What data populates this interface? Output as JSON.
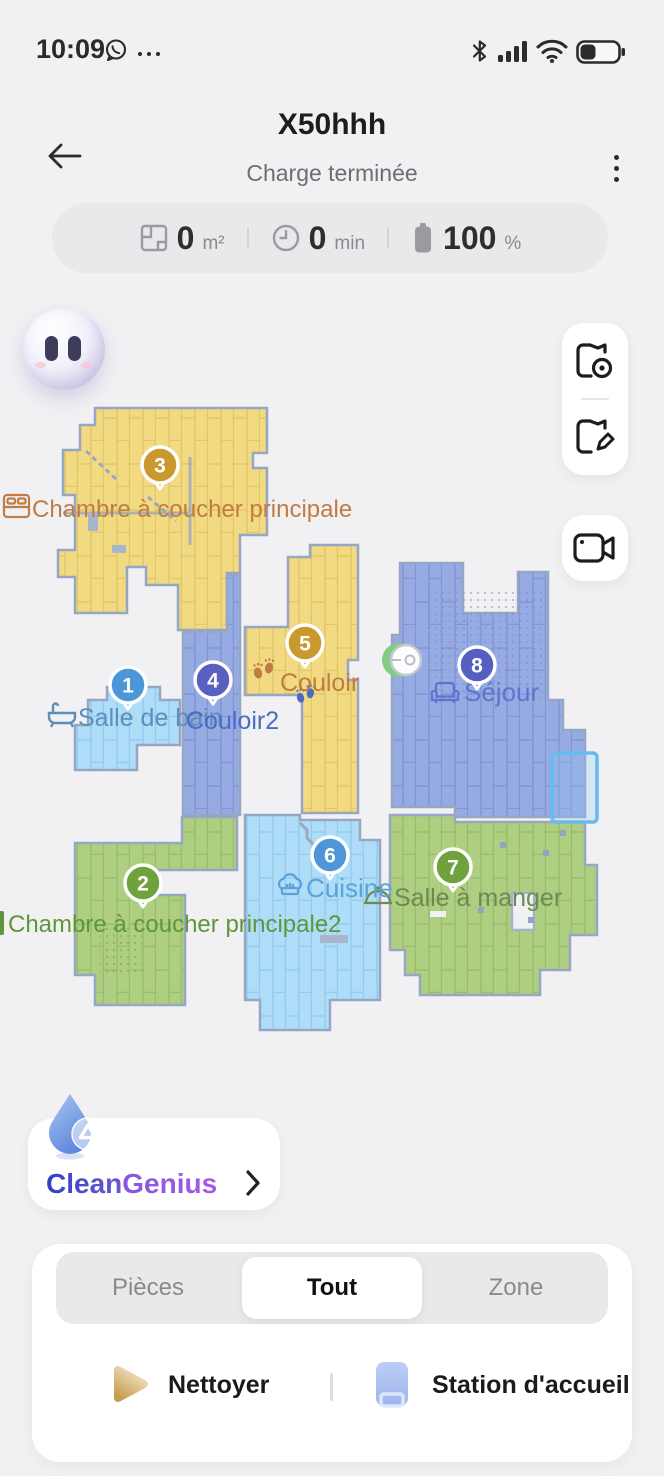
{
  "status_bar": {
    "time": "10:09",
    "whatsapp_icon": "whatsapp",
    "more_icon": "more-dots",
    "bluetooth_icon": "bluetooth",
    "signal_icon": "cellular-signal",
    "wifi_icon": "wifi",
    "battery_icon": "battery"
  },
  "header": {
    "title": "X50hhh",
    "subtitle": "Charge terminée",
    "back_icon": "back-arrow",
    "menu_icon": "kebab-menu"
  },
  "stats": {
    "area": {
      "value": "0",
      "unit": "m²"
    },
    "time": {
      "value": "0",
      "unit": "min"
    },
    "battery": {
      "value": "100",
      "unit": "%"
    }
  },
  "map": {
    "wall_color": "#96a6c4",
    "dock_icon": "robot-at-dock",
    "rooms": [
      {
        "id": 1,
        "label": "Salle de bain",
        "badge": "1",
        "badge_color": "#4d96d8",
        "label_color": "#5c8fb8",
        "fill": "#afddf8",
        "icon": "bathtub"
      },
      {
        "id": 2,
        "label": "Chambre à coucher principale2",
        "badge": "2",
        "badge_color": "#6fa23c",
        "label_color": "#5e9639",
        "fill": "#aecf82",
        "icon": "bed"
      },
      {
        "id": 3,
        "label": "Chambre à coucher principale",
        "badge": "3",
        "badge_color": "#c9982f",
        "label_color": "#c07c42",
        "fill": "#f2da82",
        "icon": "bed"
      },
      {
        "id": 4,
        "label": "Couloir2",
        "badge": "4",
        "badge_color": "#5a60c0",
        "label_color": "#4a6cc4",
        "fill": "#97abe3",
        "icon": "footprints"
      },
      {
        "id": 5,
        "label": "Couloir",
        "badge": "5",
        "badge_color": "#c9982f",
        "label_color": "#be7b42",
        "fill": "#f2da82",
        "icon": "footprints"
      },
      {
        "id": 6,
        "label": "Cuisine",
        "badge": "6",
        "badge_color": "#4d96d8",
        "label_color": "#59a3da",
        "fill": "#afddf8",
        "icon": "chef-hat"
      },
      {
        "id": 7,
        "label": "Salle à manger",
        "badge": "7",
        "badge_color": "#6fa23c",
        "label_color": "#6d8a52",
        "fill": "#aecf82",
        "icon": "cloche"
      },
      {
        "id": 8,
        "label": "Séjour",
        "badge": "8",
        "badge_color": "#555fbf",
        "label_color": "#5e74cc",
        "fill": "#97abe3",
        "icon": "sofa"
      }
    ]
  },
  "side_panel": {
    "view_map_icon": "map-view",
    "edit_map_icon": "map-edit",
    "camera_icon": "video-camera"
  },
  "clean_genius": {
    "title_part1": "Clean",
    "title_part2": "Genius",
    "drop_icon": "water-drop",
    "chevron_icon": "chevron-right"
  },
  "controls": {
    "tabs": [
      {
        "label": "Pièces",
        "active": false
      },
      {
        "label": "Tout",
        "active": true
      },
      {
        "label": "Zone",
        "active": false
      }
    ],
    "clean_action": {
      "label": "Nettoyer",
      "icon": "play"
    },
    "dock_action": {
      "label": "Station d'accueil",
      "icon": "dock-station"
    }
  }
}
